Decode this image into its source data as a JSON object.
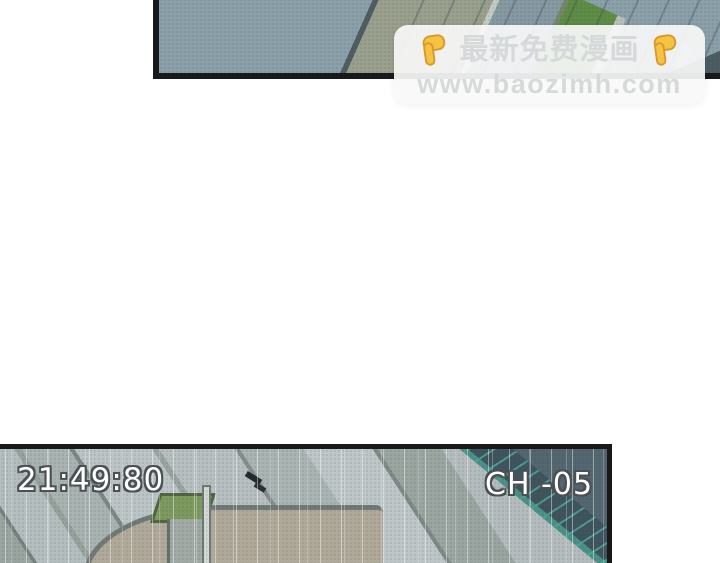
{
  "watermark": {
    "headline": "最新免费漫画",
    "url": "www.baozimh.com"
  },
  "cctv": {
    "timestamp": "21:49:80",
    "channel": "CH -05"
  },
  "icons": {
    "left_hand": "backhand-index-pointing-down",
    "right_hand": "backhand-index-pointing-down"
  },
  "colors": {
    "page-bg": "#ffffff",
    "panel-border": "#17191b",
    "top-base": "#8ca0aa",
    "road-olive": "#9aa08d",
    "grass": "#5f8d46",
    "slate-dark": "#4d5b63",
    "bottom-base": "#aeb9bd",
    "plaza-tan": "#b1aa9a",
    "curb": "#707b77",
    "kiosk-green": "#7e9a5e",
    "building": "#54666f",
    "glass-teal": "#4da795",
    "cctv-text": "#ffffff",
    "cctv-outline": "#4b5054",
    "wm-text": "#d6d9d9",
    "wm-box": "rgba(248,249,249,0.92)",
    "hand-yellow": "#f5c242",
    "hand-outline": "#d8992b"
  }
}
